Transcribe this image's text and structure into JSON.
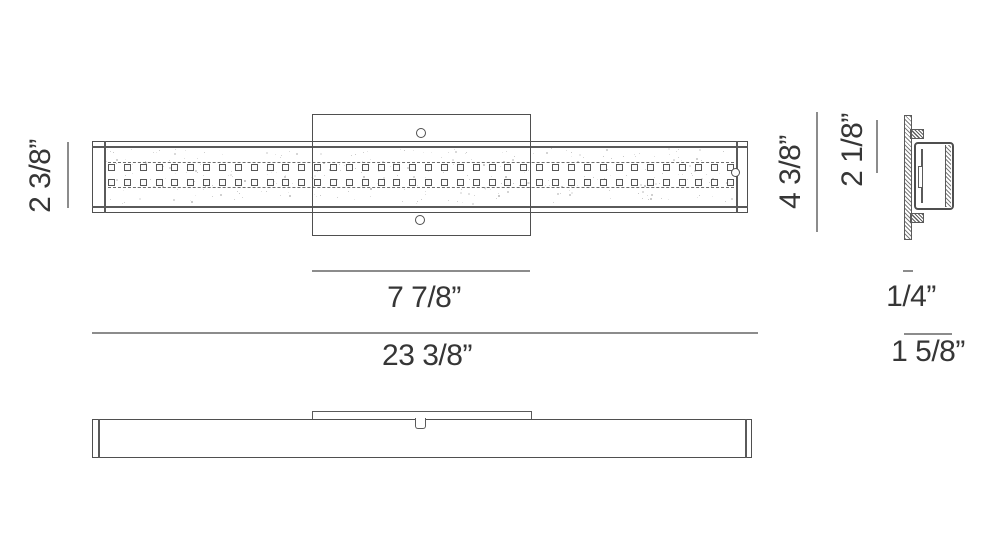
{
  "drawing": {
    "type": "technical-dimension-drawing",
    "subject": "linear vanity light fixture"
  },
  "colors": {
    "background": "#ffffff",
    "drawing_line": "#4f4f4f",
    "dimension_line": "#8c8c8c",
    "text": "#363636",
    "speckle": "#8a8a8a"
  },
  "views": {
    "front": {
      "crystal_rows": 2,
      "crystals_per_row": 40,
      "speckle_count": 300
    },
    "side": {},
    "bottom": {}
  },
  "dimensions": {
    "fixture_height": "2 3/8”",
    "canopy_width": "7 7/8”",
    "fixture_width": "23 3/8”",
    "overall_height": "4 3/8”",
    "body_height": "2 1/8”",
    "canopy_depth": "1/4”",
    "extension_depth": "1 5/8”"
  }
}
